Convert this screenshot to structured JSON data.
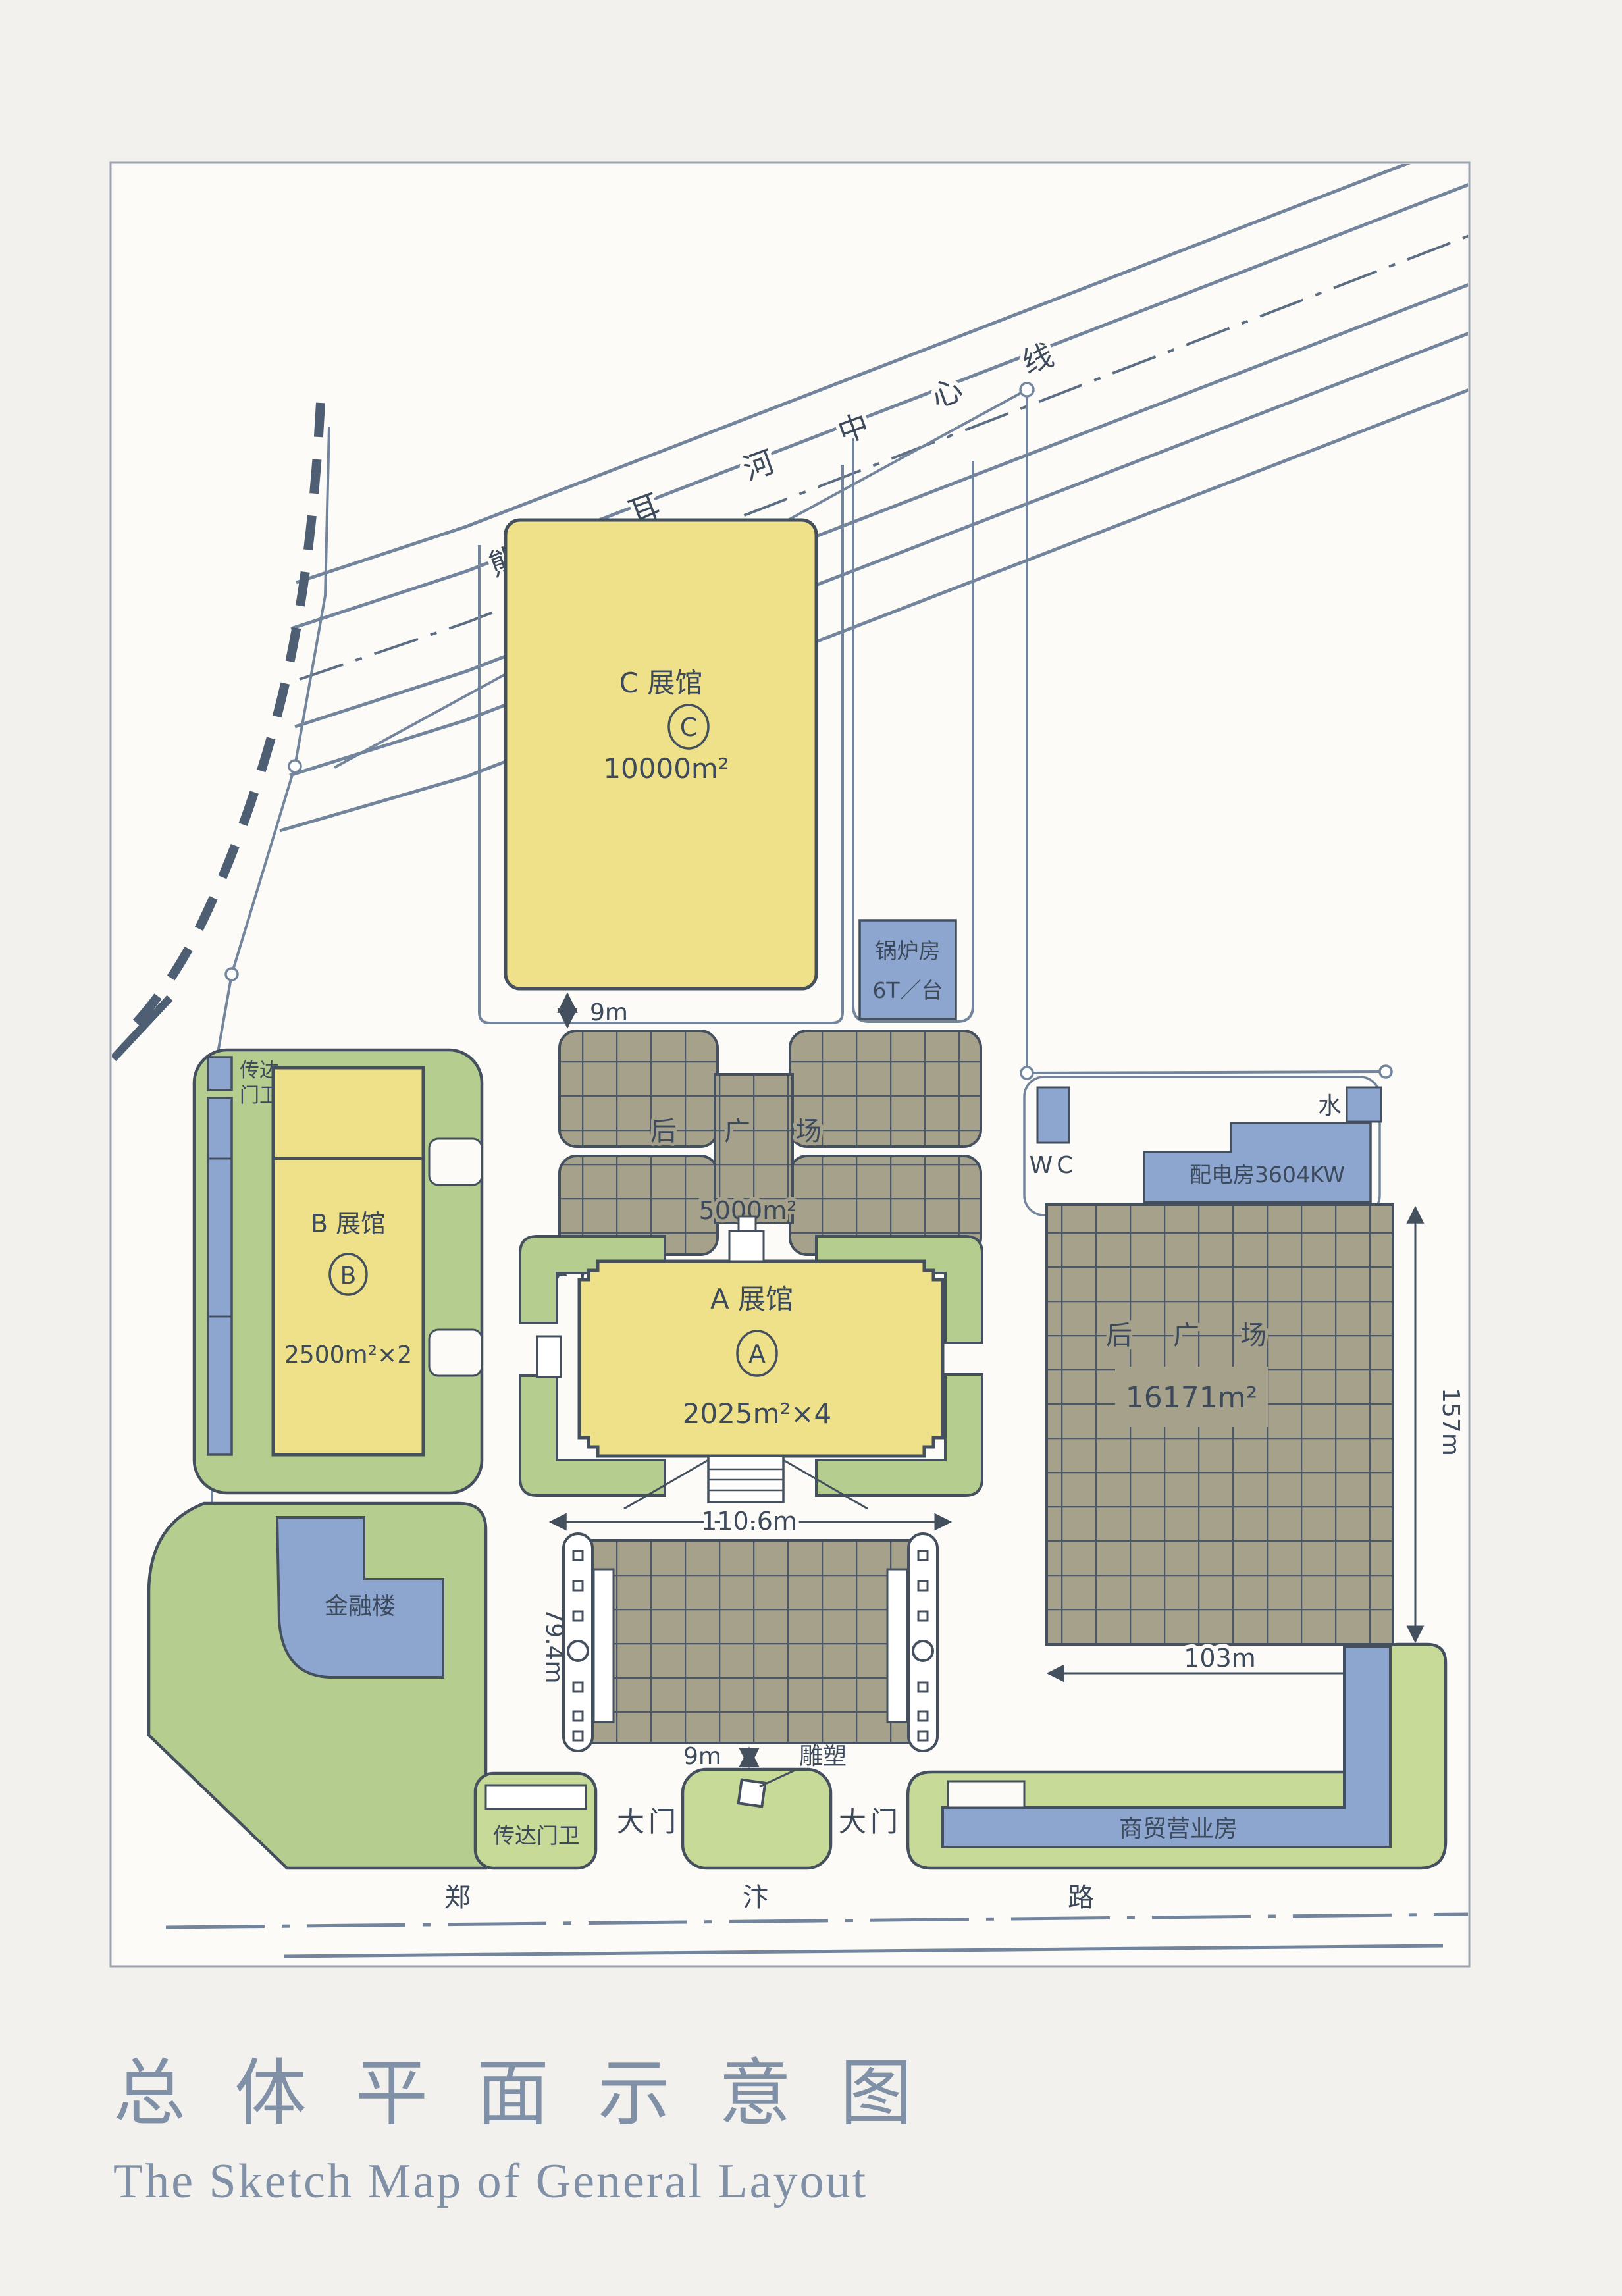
{
  "palette": {
    "page": "#f3f1ed",
    "paper": "#fcfbf7",
    "yellow": "#eee189",
    "green": "#b5cd8f",
    "green_light": "#c8da97",
    "blue": "#8da6d0",
    "plaza": "#a6a18a",
    "grid_line": "#4c5868",
    "dark": "#45505e",
    "line": "#72859c",
    "ink": "#3d4a5c",
    "title": "#8091a7"
  },
  "title": {
    "zh": "总体平面示意图",
    "en": "The Sketch Map of General Layout"
  },
  "river": {
    "chars": [
      "熊",
      "耳",
      "河",
      "中",
      "心",
      "线"
    ]
  },
  "road": {
    "chars": [
      "郑",
      "汴",
      "路"
    ]
  },
  "halls": {
    "c": {
      "name": "C 展馆",
      "mark": "C",
      "area": "10000m²"
    },
    "a": {
      "name": "A 展馆",
      "mark": "A",
      "area": "2025m²×4"
    },
    "b": {
      "name": "B 展馆",
      "mark": "B",
      "area": "2500m²×2"
    }
  },
  "facilities": {
    "boiler_line1": "锅炉房",
    "boiler_line2": "6T／台",
    "wc": "WC",
    "power": "配电房3604KW",
    "water": "水",
    "finance": "金融楼",
    "commerce": "商贸营业房",
    "gatehouse_nw_line1": "传达",
    "gatehouse_nw_line2": "门卫",
    "gatehouse_s": "传达门卫",
    "gate_left": "大门",
    "gate_right": "大门",
    "sculpture": "雕塑"
  },
  "plaza_north": {
    "c1": "后",
    "c2": "广",
    "c3": "场",
    "area": "5000m²"
  },
  "plaza_east": {
    "c1": "后",
    "c2": "广",
    "c3": "场",
    "area": "16171m²"
  },
  "dims": {
    "gap_c": "9m",
    "gap_a": "6m",
    "a_width": "110.6m",
    "front_depth": "79.4m",
    "front_gap": "9m",
    "east_w": "103m",
    "east_h": "157m"
  }
}
